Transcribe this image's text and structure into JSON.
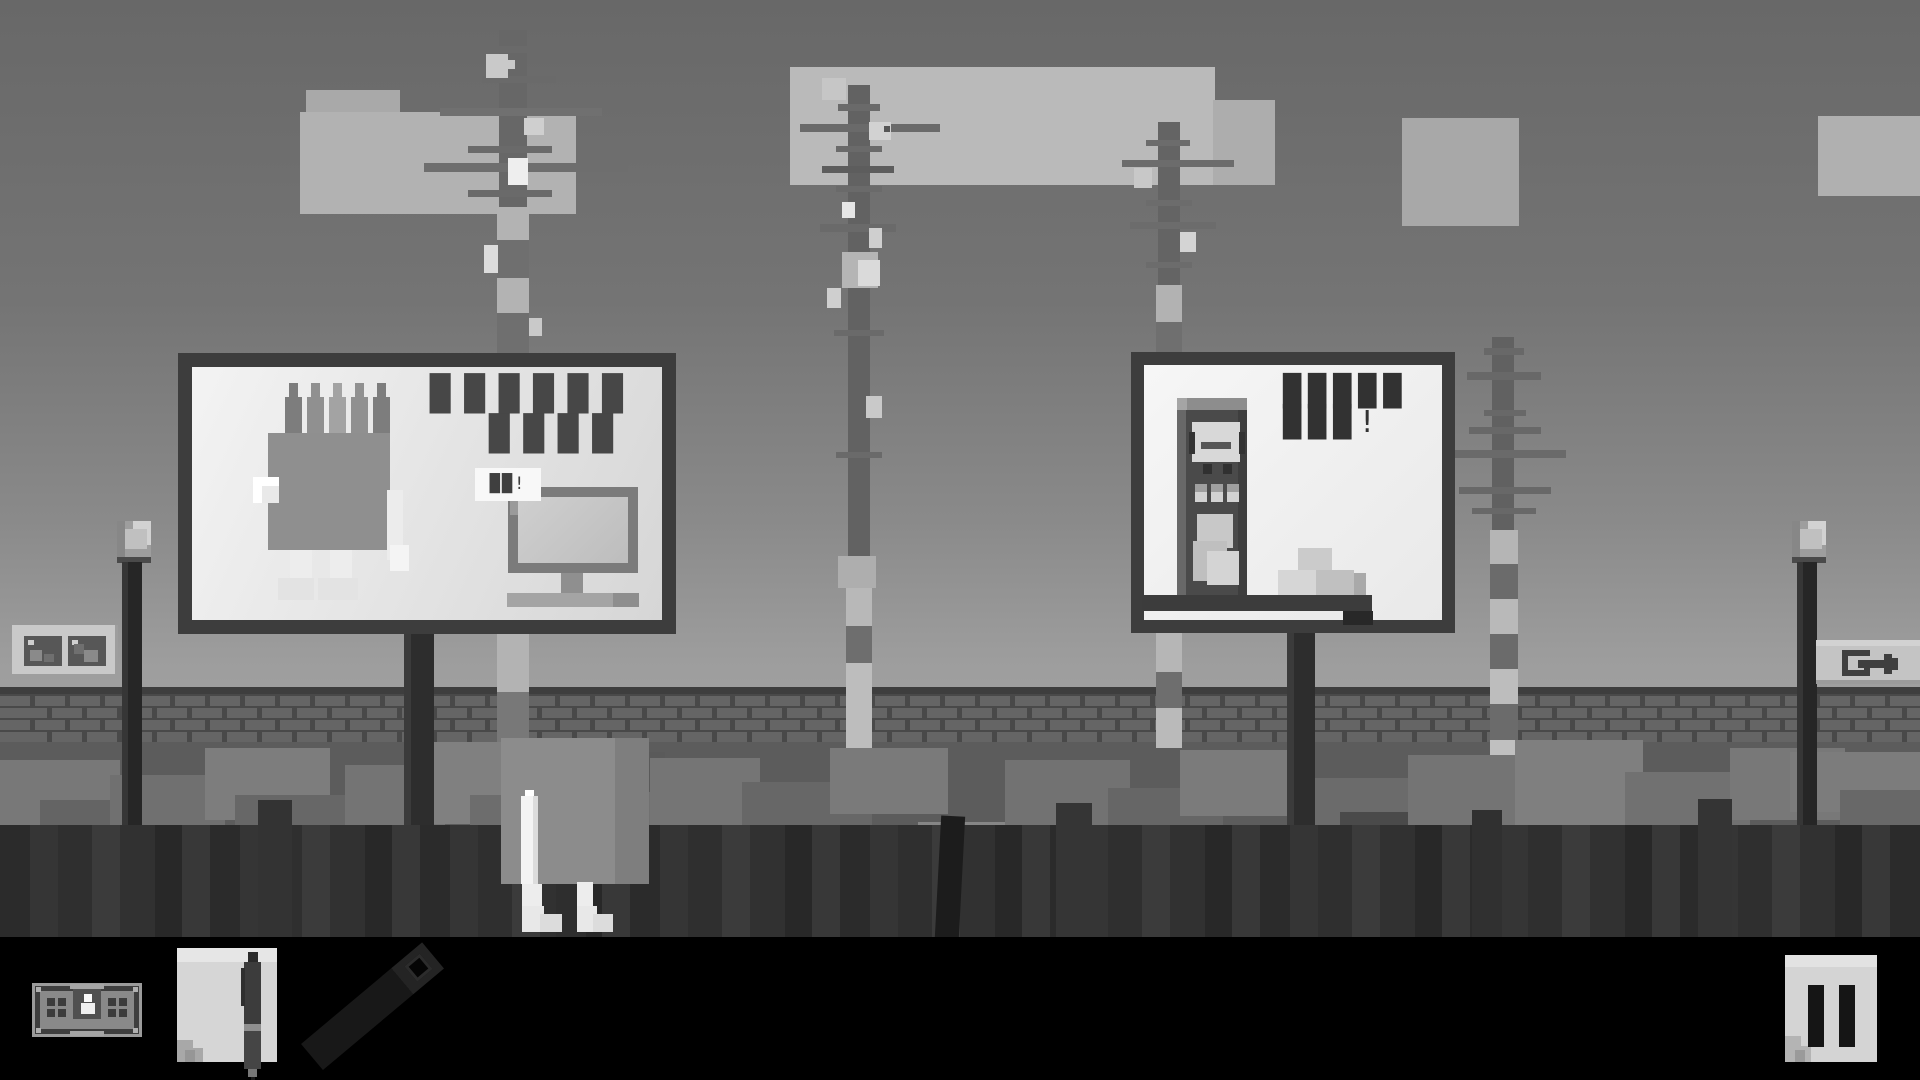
{
  "scene": {
    "billboard_left": {
      "headline_line1": "██████",
      "headline_line2": "████",
      "placard_text": "██!",
      "figures": [
        "chip-mascot",
        "desktop-monitor"
      ]
    },
    "billboard_right": {
      "headline_line1": "█████",
      "headline_line2": "███!",
      "figures": [
        "vending-machine",
        "stacked-boxes"
      ]
    },
    "icons": [
      "banknote-icon",
      "notepad-icon",
      "pen-icon",
      "ruler-icon",
      "pause-icon",
      "exit-icon",
      "framed-pictures-icon",
      "lamppost",
      "antenna-mast"
    ],
    "palette": {
      "sky_top": "#686868",
      "sky_horizon": "#a4a4a4",
      "billboard_frame": "#3d3d3d",
      "billboard_face": "#f2f2f2",
      "wall_brick": "#656565",
      "fence_dark": "#2f2f2f",
      "hud_bar": "#000000",
      "paper_light": "#d4d4d4",
      "fake_text": "#3a3a3a"
    }
  }
}
